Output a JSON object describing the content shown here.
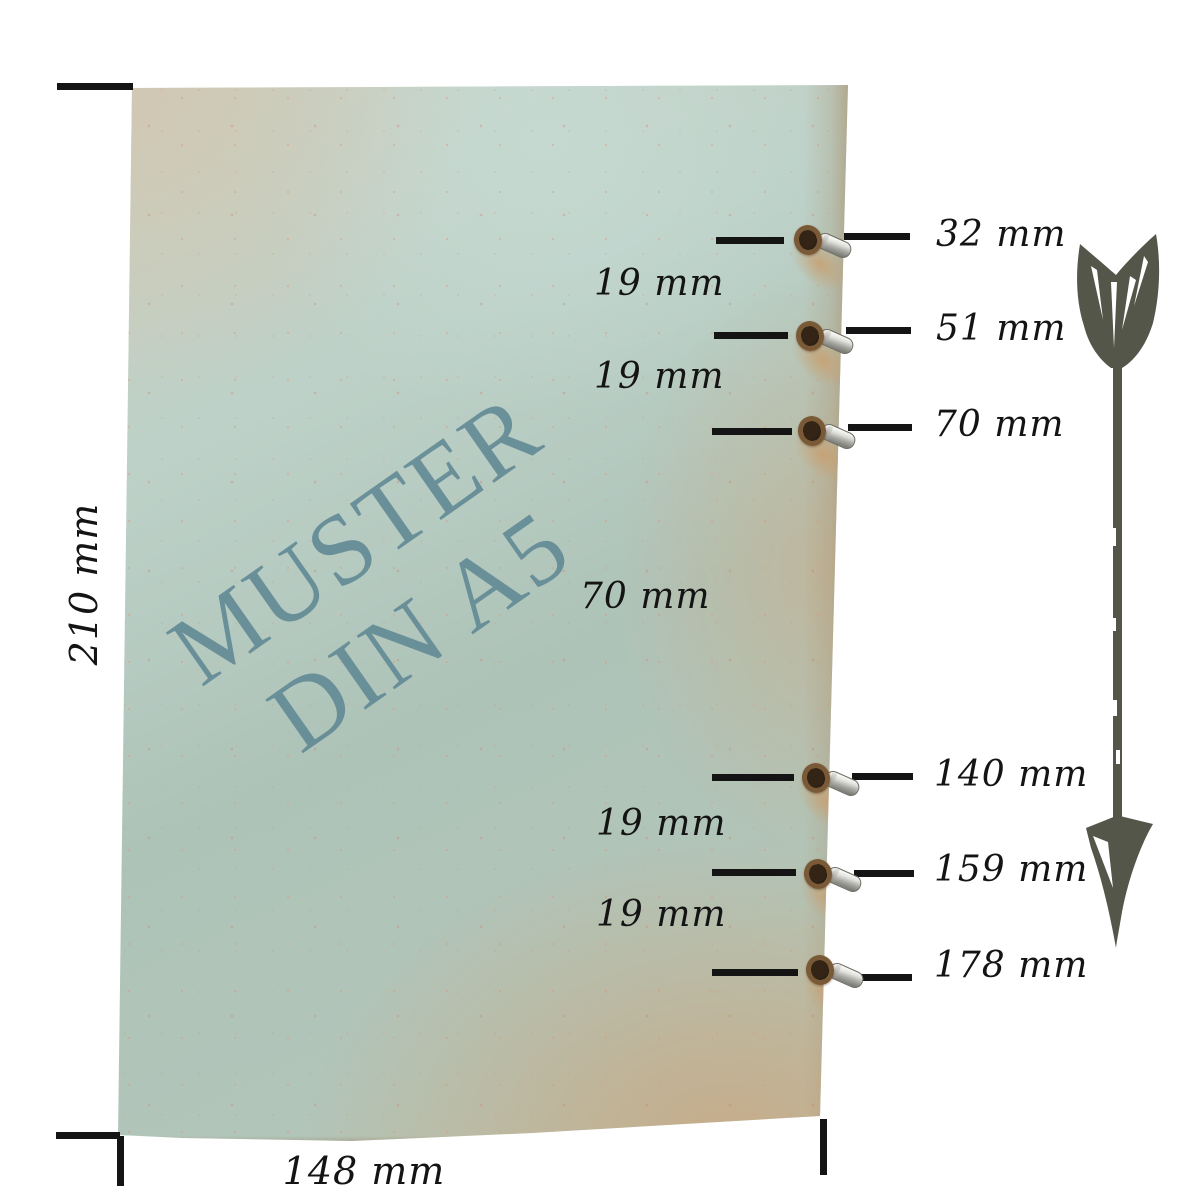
{
  "watermark": {
    "line1": "MUSTER",
    "line2": "DIN A5"
  },
  "page_dimensions": {
    "height_label": "210 mm",
    "width_label": "148 mm"
  },
  "hole_labels": [
    "32 mm",
    "51 mm",
    "70 mm",
    "140 mm",
    "159 mm",
    "178 mm"
  ],
  "spacing_labels": [
    "19 mm",
    "19 mm",
    "70 mm",
    "19 mm",
    "19 mm"
  ],
  "icons": {
    "arrow": "down-arrow-icon",
    "eyelet": "metal-eyelet",
    "hole": "punched-hole"
  },
  "colors": {
    "paper_teal": "#aec3b8",
    "paper_kraft": "#cdc4b2",
    "paper_edge_tan": "#c2a685",
    "watermark_text": "#5e8793",
    "measurement_line": "#141414",
    "arrow": "#54564a",
    "eyelet_silver": "#c9c9c6",
    "background": "#ffffff"
  }
}
